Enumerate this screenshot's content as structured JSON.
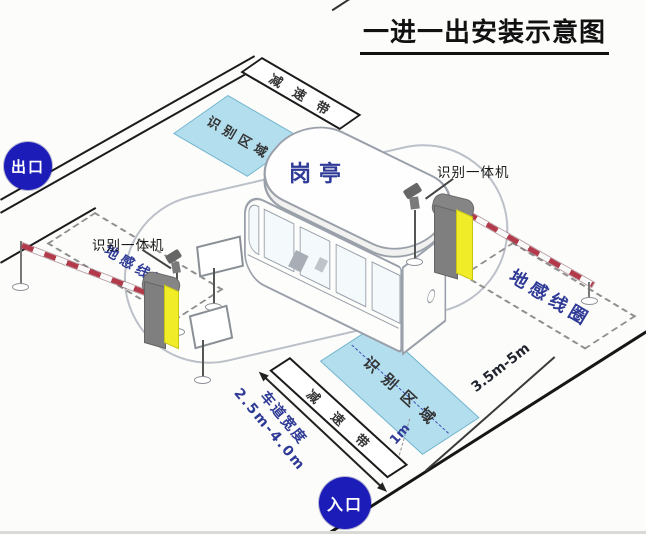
{
  "title": {
    "text": "一进一出安装示意图"
  },
  "badges": {
    "exit": "出口",
    "entrance": "入口"
  },
  "booth": {
    "label": "岗亭"
  },
  "exit_lane": {
    "speed_bump": "减速带",
    "recognition_area": "识别区域",
    "ground_coil": "地感线圈",
    "camera_label": "识别一体机"
  },
  "entrance_lane": {
    "speed_bump": "减速带",
    "recognition_area": "识别区域",
    "ground_coil": "地感线圈",
    "camera_label": "识别一体机",
    "coil_distance": "3.5m-5m",
    "area_distance": "1m",
    "lane_width_title": "车道宽度",
    "lane_width_range": "2.5m-4.0m"
  },
  "colors": {
    "label_blue": "#2e3a96",
    "badge_blue": "#1c1cb8",
    "area_fill": "#addbed",
    "area_border": "#74b6ce",
    "machine_yellow": "#f0ec28",
    "machine_gray": "#7f7f7f",
    "arm_stripe_red": "#b23a4b",
    "line_black": "#1b1b1b"
  }
}
